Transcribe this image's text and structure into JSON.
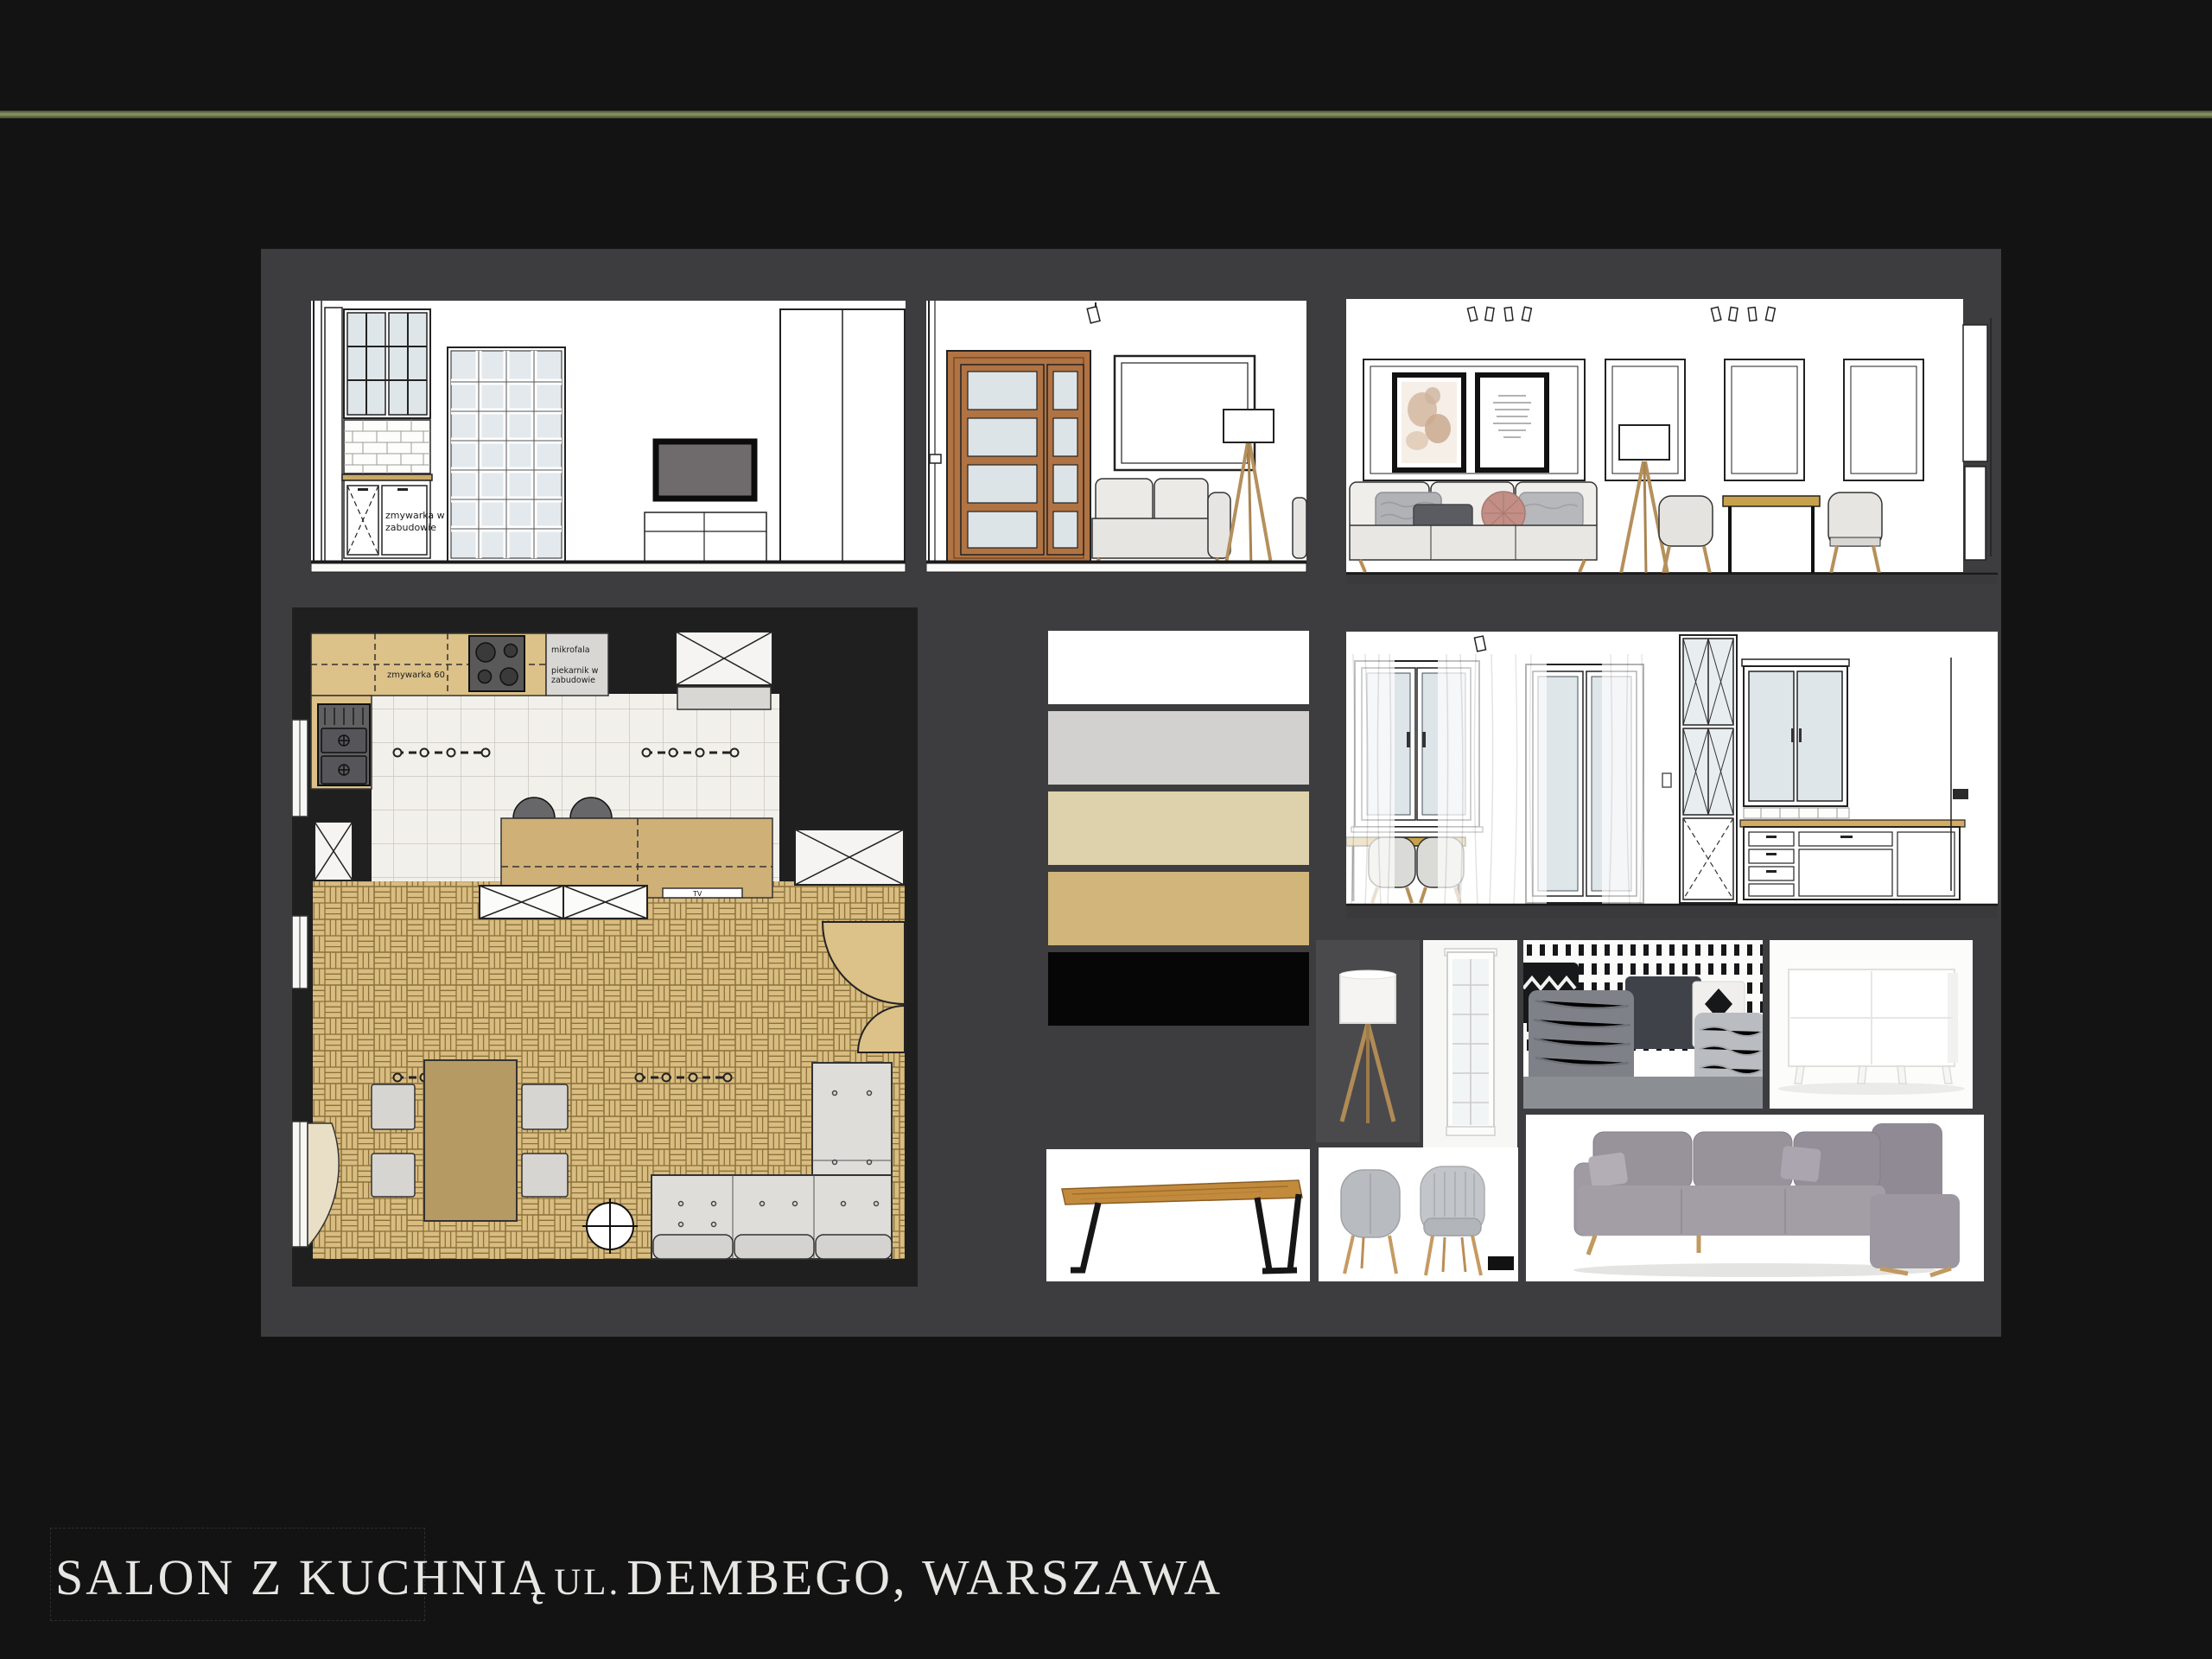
{
  "page": {
    "background": "#131313",
    "accent_line_color": "#76815a",
    "board_color": "#3d3d3f"
  },
  "title": {
    "part1": "SALON Z KUCHNIĄ",
    "part2": "UL.",
    "part3": "DEMBEGO, WARSZAWA"
  },
  "plan_labels": {
    "zmywarka": "zmywarka 60",
    "mikrofala": "mikrofala",
    "piekarnik_line1": "piekarnik w",
    "piekarnik_line2": "zabudowie",
    "tv": "TV"
  },
  "elevation_labels": {
    "dishwasher_line1": "zmywarka w",
    "dishwasher_line2": "zabudowie"
  },
  "palette": {
    "swatches": [
      {
        "name": "white",
        "hex": "#ffffff"
      },
      {
        "name": "light-gray",
        "hex": "#d2d1cf"
      },
      {
        "name": "cream",
        "hex": "#ded2ad"
      },
      {
        "name": "gold",
        "hex": "#d1b57b"
      },
      {
        "name": "black",
        "hex": "#060606"
      }
    ]
  }
}
